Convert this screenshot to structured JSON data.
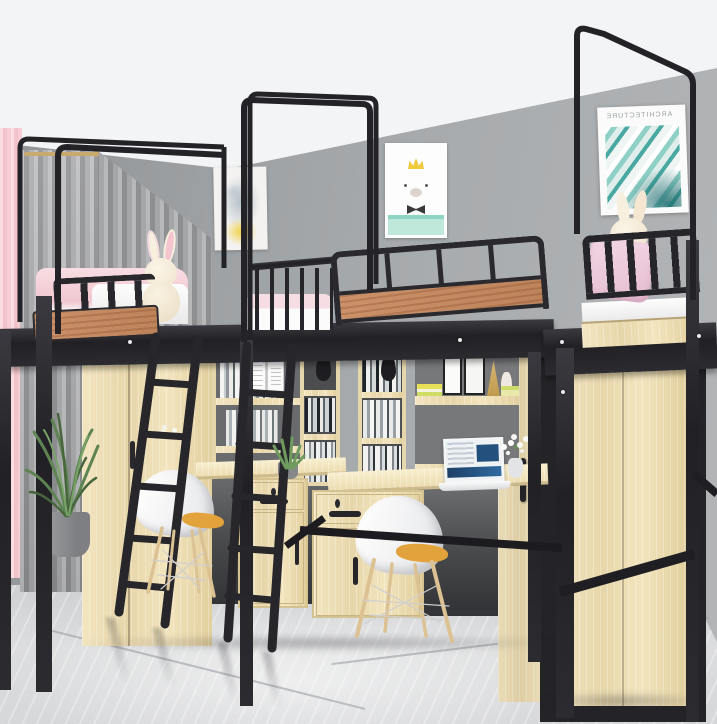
{
  "scene": {
    "description": "Dormitory room photo: three black metal loft beds with canopy poles over wooden wardrobes, bookshelves and desks, white shell chairs, marble floor",
    "room": {
      "wall_color": "#a1a4a6",
      "ceiling_color": "#f3f4f5",
      "floor_color": "#d9dadc"
    },
    "posters": [
      {
        "name": "watercolor-bear-poster",
        "text": ""
      },
      {
        "name": "crown-bear-poster",
        "text": ""
      },
      {
        "name": "architecture-poster",
        "text": "ARCHITECTURE",
        "text_mirrored": true
      }
    ],
    "objects": [
      "pink-curtain",
      "gray-curtain",
      "curtain-rod",
      "loft-bed-left",
      "loft-bed-middle",
      "loft-bed-right",
      "canopy-frame-left",
      "canopy-frame-middle",
      "canopy-frame-right",
      "guard-rail-wood-panel",
      "bunny-plush-left",
      "bunny-plush-right",
      "pink-pillow",
      "pink-bedding",
      "ladder-left",
      "ladder-middle",
      "wardrobe-left",
      "wardrobe-middle",
      "wardrobe-right",
      "bookshelf-left",
      "bookshelf-middle",
      "hutch-right",
      "black-vases",
      "picture-frames",
      "desk-left",
      "desk-middle",
      "drawer-pedestal-left",
      "drawer-pedestal-middle",
      "laptop",
      "white-flowers",
      "aloe-plant",
      "potted-plant",
      "shell-chair-left",
      "shell-chair-right",
      "marble-floor",
      "gray-wall",
      "white-ceiling"
    ],
    "palette": {
      "metal": "#26262a",
      "wood": "#ecdcb2",
      "woodLight": "#f7eecb",
      "woodDark": "#d9c595",
      "panelWood": "#c2875e",
      "wall": "#a1a4a6",
      "ceiling": "#f3f4f5",
      "floor": "#d9dadc",
      "curtainPink": "#f6cdd3",
      "curtainGray": "#a2a3a5",
      "bedding": "#f3cdd6",
      "pillowPink": "#eccadb",
      "cushion": "#e2a33c",
      "teal": "#3fa89e",
      "mint": "#bfe7da",
      "plant": "#5d8452",
      "pot": "#8e9092",
      "chairWood": "#dcc193",
      "cream": "#f6edda"
    }
  }
}
